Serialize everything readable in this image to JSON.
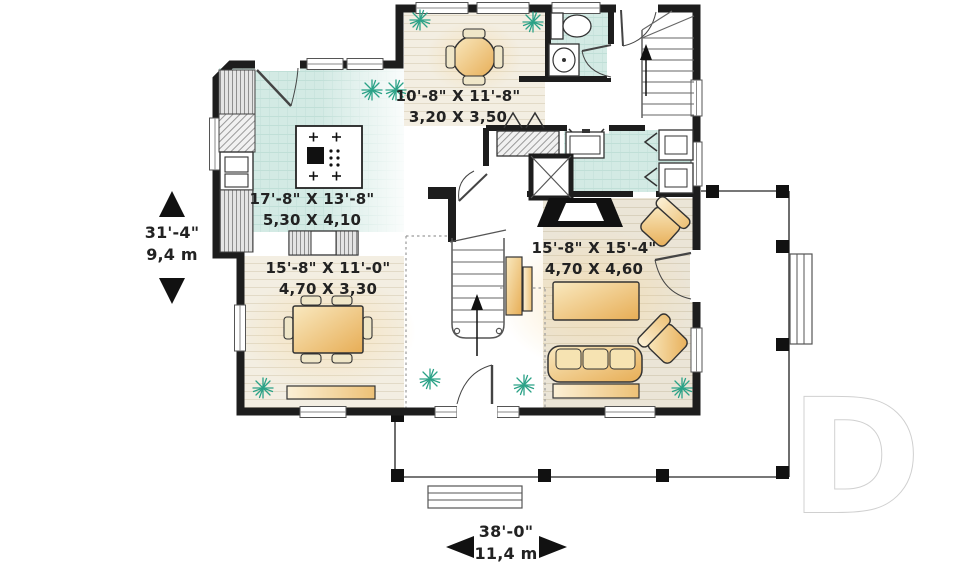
{
  "floorplan": {
    "rooms": {
      "breakfast_nook": {
        "imperial": "10'-8\" X 11'-8\"",
        "metric": "3,20 X 3,50"
      },
      "kitchen": {
        "imperial": "17'-8\" X 13'-8\"",
        "metric": "5,30 X 4,10"
      },
      "dining_room": {
        "imperial": "15'-8\" X 11'-0\"",
        "metric": "4,70 X 3,30"
      },
      "living_room": {
        "imperial": "15'-8\" X 15'-4\"",
        "metric": "4,70 X 4,60"
      }
    },
    "overall_dimensions": {
      "depth": {
        "imperial": "31'-4\"",
        "metric": "9,4 m"
      },
      "width": {
        "imperial": "38'-0\"",
        "metric": "11,4 m"
      }
    },
    "watermark_letter": "D",
    "colors": {
      "wall": "#1d1d1d",
      "tile_floor": "#d3eae4",
      "wood_floor": "#f2ecdf",
      "furniture": "#edc271",
      "plant": "#2ba287",
      "porch_line": "#4a4a4a",
      "watermark_outline": "#d0d0d0"
    }
  }
}
